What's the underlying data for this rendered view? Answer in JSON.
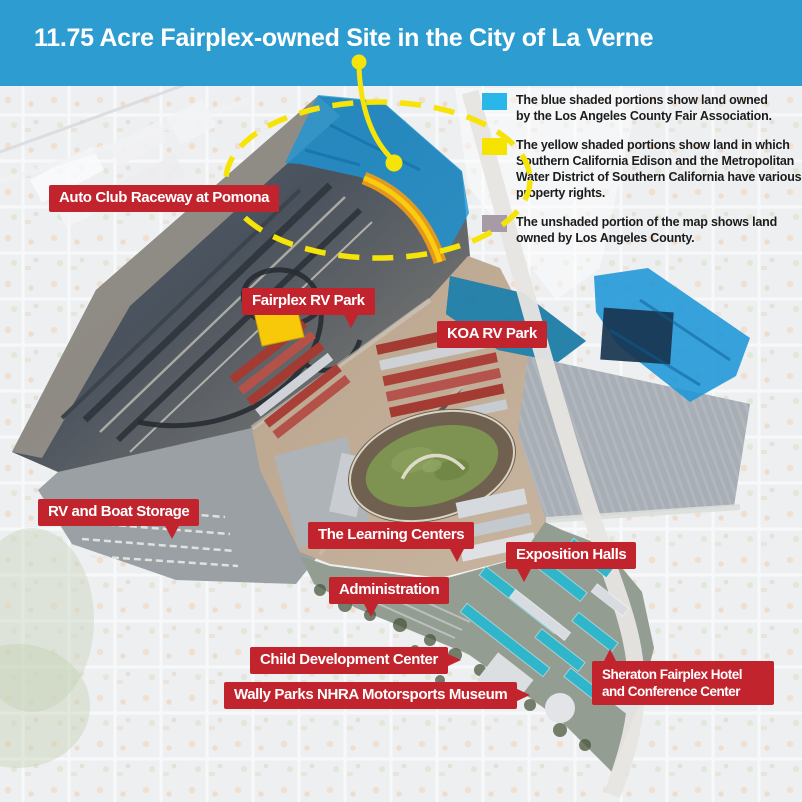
{
  "title": "11.75 Acre Fairplex-owned Site in the City of La Verne",
  "colors": {
    "titlebar_bg": "#2D9DD1",
    "label_bg": "#C2242E",
    "label_text": "#FFFFFF",
    "highlight_yellow": "#F6E409",
    "map_blue_overlay": "#1D96D6",
    "map_orange_strip": "#F09C16",
    "legend_blue_swatch": "#29B6E8",
    "legend_yellow_swatch": "#F6E400",
    "legend_gray_swatch": "#A79BA7"
  },
  "legend": {
    "items": [
      {
        "id": "blue-shaded",
        "swatch_color": "#29B6E8",
        "lines": [
          "The blue shaded portions show land owned",
          "by the Los Angeles County Fair Association."
        ]
      },
      {
        "id": "yellow-shaded",
        "swatch_color": "#F6E400",
        "lines": [
          "The yellow shaded portions show land in which",
          "Southern California Edison and the Metropolitan",
          "Water District of Southern California have various",
          "property rights."
        ]
      },
      {
        "id": "unshaded",
        "swatch_color": "#A79BA7",
        "lines": [
          "The unshaded portion of the map shows land",
          "owned by Los Angeles County."
        ]
      }
    ]
  },
  "map": {
    "labels": [
      {
        "id": "auto-club-raceway",
        "lines": [
          "Auto Club Raceway at Pomona"
        ]
      },
      {
        "id": "fairplex-rv-park",
        "lines": [
          "Fairplex RV Park"
        ]
      },
      {
        "id": "koa-rv-park",
        "lines": [
          "KOA RV Park"
        ]
      },
      {
        "id": "rv-and-boat-storage",
        "lines": [
          "RV and Boat Storage"
        ]
      },
      {
        "id": "the-learning-centers",
        "lines": [
          "The Learning Centers"
        ]
      },
      {
        "id": "administration",
        "lines": [
          "Administration"
        ]
      },
      {
        "id": "exposition-halls",
        "lines": [
          "Exposition Halls"
        ]
      },
      {
        "id": "child-development-center",
        "lines": [
          "Child Development Center"
        ]
      },
      {
        "id": "wally-parks-nhra-motorsports-museum",
        "lines": [
          "Wally Parks NHRA Motorsports Museum"
        ]
      },
      {
        "id": "sheraton-fairplex-hotel",
        "lines": [
          "Sheraton Fairplex Hotel",
          "and Conference Center"
        ]
      }
    ]
  }
}
